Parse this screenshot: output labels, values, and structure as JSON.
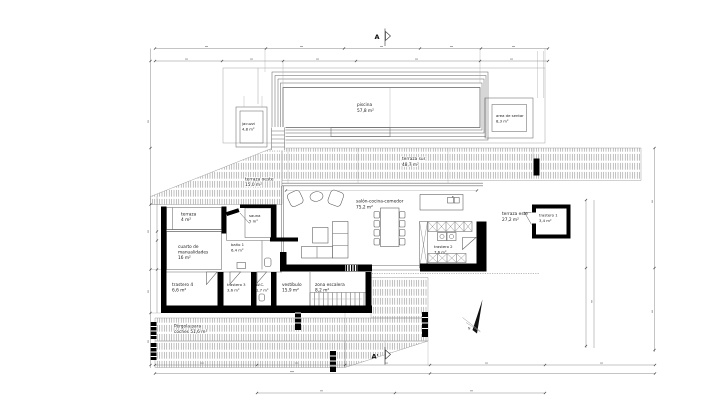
{
  "markers": {
    "section_top": "A",
    "section_bottom": "A'",
    "north": "N"
  },
  "colors": {
    "wall": "#000000",
    "thin_line": "#6b6b6b",
    "hatch_line": "#8a8a8a",
    "text": "#1a1a1a",
    "background": "#ffffff"
  },
  "rooms": {
    "piscina": {
      "name": "piscina",
      "area": "57,8 m²"
    },
    "jacuzzi": {
      "name": "jacuzzi",
      "area": "4,8 m²"
    },
    "area_de_sentar": {
      "name": "area de sentar",
      "area": "8,3 m²"
    },
    "terraza_sur": {
      "name": "terraza sur",
      "area": "48,7 m²"
    },
    "terraza_oeste": {
      "name": "terraza oeste",
      "area": "15,0 m²"
    },
    "salon_cocina_comedor": {
      "name": "salón-cocina-comedor",
      "area": "75,2 m²"
    },
    "terraza_este": {
      "name": "terraza este",
      "area": "27,2 m²"
    },
    "trastero_1": {
      "name": "trastero 1",
      "area": "3,4 m²"
    },
    "terraza": {
      "name": "terraza",
      "area": "4 m²"
    },
    "sauna": {
      "name": "sauna",
      "area": "5 m²"
    },
    "cuarto_manualidades": {
      "line1": "cuarto de",
      "line2": "manualidades",
      "area": "16 m²"
    },
    "bano_1": {
      "name": "baño 1",
      "area": "6,4 m²"
    },
    "trastero_4": {
      "name": "trastero 4",
      "area": "6,6 m²"
    },
    "trastero_3": {
      "name": "trastero 3",
      "area": "3,6 m²"
    },
    "wc": {
      "name": "W.C.",
      "area": "1,7 m²"
    },
    "vestibulo": {
      "name": "vestíbulo",
      "area": "15,9 m²"
    },
    "zona_escalera": {
      "name": "zona escalera",
      "area": "8,2 m²"
    },
    "trastero_2": {
      "name": "trastero 2",
      "area": "7,6 m²"
    },
    "pergola": {
      "line1": "Pérgola para",
      "line2": "coches 51,6 m²"
    }
  }
}
